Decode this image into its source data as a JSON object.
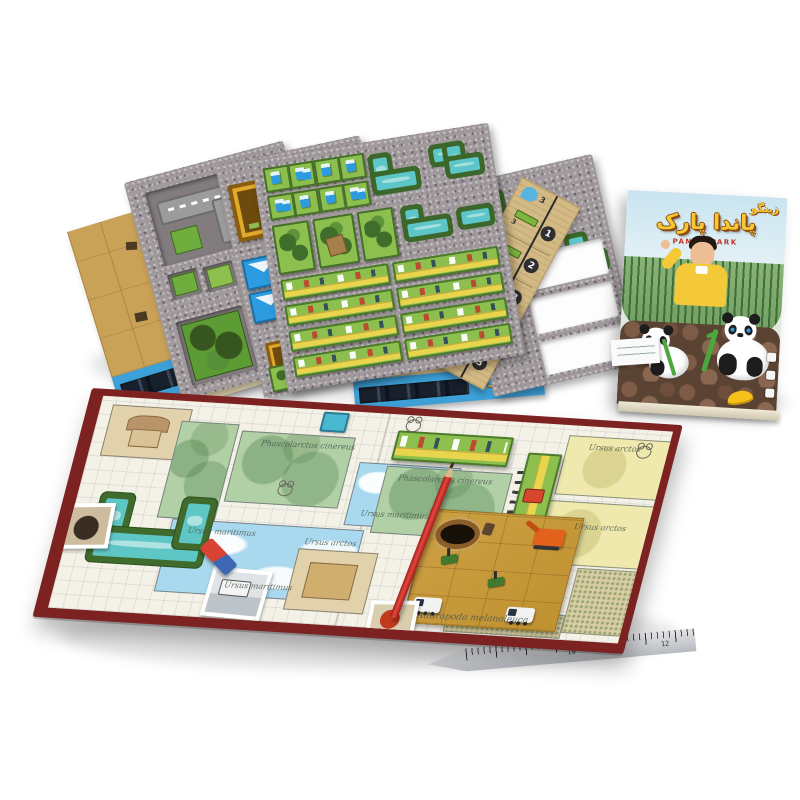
{
  "box": {
    "brand": "زینگو",
    "title_fa": "پاندا پارک",
    "title_en": "PANDA PARK"
  },
  "stack": {
    "folded_board_title": "پاندا پارک",
    "player_board_title": "پاندا پارک",
    "player_piece_values": [
      "6",
      "6"
    ],
    "score_strip": {
      "water_value": "3",
      "sections": [
        {
          "piece": "3",
          "score": "1"
        },
        {
          "piece": "3",
          "score": "2"
        },
        {
          "piece": "3",
          "score": "3"
        },
        {
          "piece": "6",
          "score": "3"
        },
        {
          "piece": "6",
          "score": "3"
        }
      ]
    }
  },
  "board": {
    "labels": {
      "koala": "Phascolarctos cinereus",
      "polar_bear": "Ursus maritimus",
      "brown_bear": "Ursus arctos",
      "panda": "Ailuropoda melanoleuca"
    }
  },
  "ruler": {
    "numbers": [
      "10",
      "11",
      "12"
    ]
  },
  "palette": {
    "board_border": "#7c2220",
    "cardboard": "#a29b9e",
    "water": "#5cc6c8",
    "tile_green": "#85b945",
    "road_yellow": "#e8d44d",
    "strip_blue": "#3da0d8",
    "title_yellow": "#f8c832"
  }
}
